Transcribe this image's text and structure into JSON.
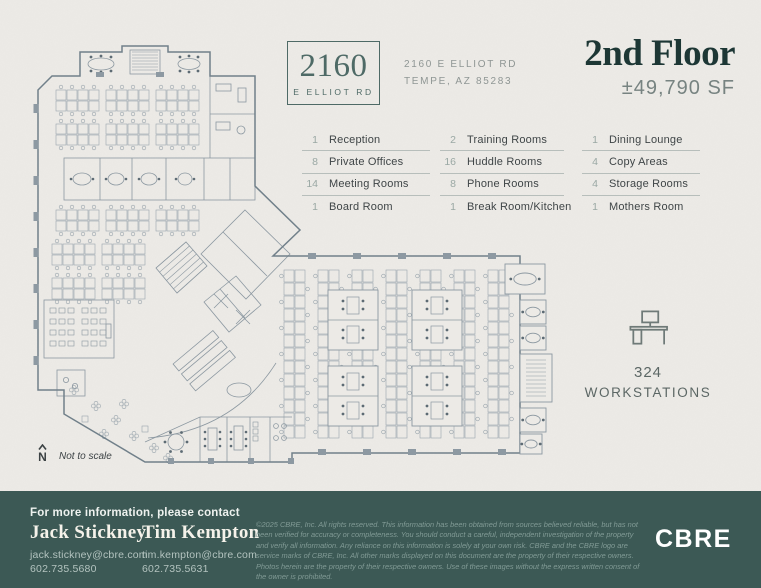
{
  "header": {
    "logo_number": "2160",
    "logo_street": "E ELLIOT RD",
    "address_line1": "2160 E ELLIOT RD",
    "address_line2": "TEMPE, AZ 85283",
    "floor_title": "2nd Floor",
    "floor_area": "±49,790 SF"
  },
  "amenities": {
    "columns": [
      {
        "items": [
          {
            "count": "1",
            "label": "Reception"
          },
          {
            "count": "8",
            "label": "Private Offices"
          },
          {
            "count": "14",
            "label": "Meeting Rooms"
          },
          {
            "count": "1",
            "label": "Board Room"
          }
        ]
      },
      {
        "items": [
          {
            "count": "2",
            "label": "Training Rooms"
          },
          {
            "count": "16",
            "label": "Huddle Rooms"
          },
          {
            "count": "8",
            "label": "Phone Rooms"
          },
          {
            "count": "1",
            "label": "Break Room/Kitchen"
          }
        ]
      },
      {
        "items": [
          {
            "count": "1",
            "label": "Dining Lounge"
          },
          {
            "count": "4",
            "label": "Copy Areas"
          },
          {
            "count": "4",
            "label": "Storage Rooms"
          },
          {
            "count": "1",
            "label": "Mothers Room"
          }
        ]
      }
    ]
  },
  "workstations": {
    "count": "324",
    "label": "WORKSTATIONS"
  },
  "floorplan": {
    "north_label": "N",
    "scale_note": "Not to scale"
  },
  "footer": {
    "contact_heading": "For more information, please contact",
    "contacts": [
      {
        "name": "Jack Stickney",
        "email": "jack.stickney@cbre.com",
        "phone": "602.735.5680"
      },
      {
        "name": "Tim Kempton",
        "email": "tim.kempton@cbre.com",
        "phone": "602.735.5631"
      }
    ],
    "disclaimer": "©2025 CBRE, Inc. All rights reserved. This information has been obtained from sources believed reliable, but has not been verified for accuracy or completeness. You should conduct a careful, independent investigation of the property and verify all information. Any reliance on this information is solely at your own risk. CBRE and the CBRE logo are service marks of CBRE, Inc. All other marks displayed on this document are the property of their respective owners. Photos herein are the property of their respective owners. Use of these images without the express written consent of the owner is prohibited.",
    "brand_logo": "CBRE"
  },
  "colors": {
    "paper": "#ECEAE6",
    "teal": "#4E6A66",
    "teal-dark": "#1D3735",
    "footer-bg": "#3C5955",
    "ink": "#3F4547",
    "muted": "#8F9694",
    "num": "#9AA8A4",
    "line": "#B7BEBB",
    "ws": "#5C6765",
    "plan-wall": "#71808A",
    "plan-inner": "#8C98A1",
    "plan-desk": "#9AA5AD",
    "plan-dot": "#5D6B74"
  }
}
